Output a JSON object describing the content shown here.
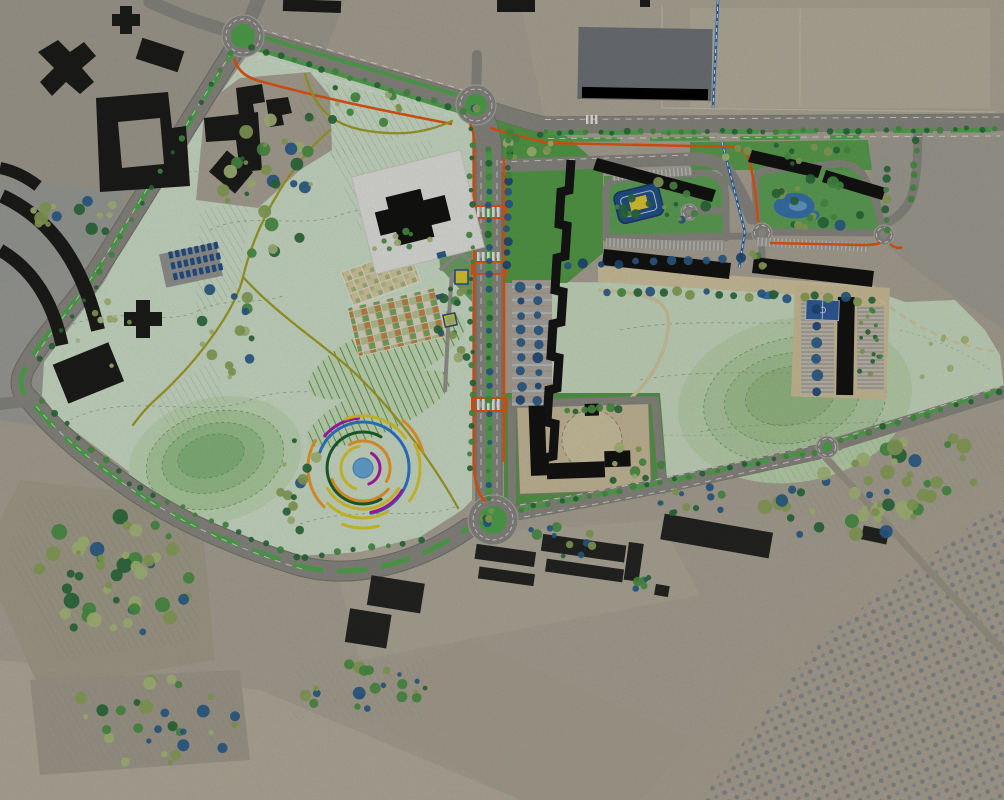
{
  "map": {
    "kind": "landscape-masterplan-over-aerial-photo",
    "canvas": {
      "width": 1004,
      "height": 800
    },
    "palette": {
      "aerial_base": "#b2ab9c",
      "aerial_cool": "#a3a49c",
      "park_mint": "#d5e7d1",
      "meadow_mint": "#cfe3c8",
      "lawn_green": "#58a24c",
      "median_green": "#55ad52",
      "route_orange": "#ee5a14",
      "canal_blue": "#2e6cb0",
      "road_gray": "#908e86",
      "building_black": "#1c1c1b",
      "white_parcel": "#ebebe8",
      "pond_blue": "#3b77b5",
      "court_blue": "#31609f",
      "pavilion_yellow": "#e7cf36",
      "garden_tan": "#d2c49c",
      "garden_orange": "#c98b4f",
      "garden_green": "#7fae62"
    },
    "features": [
      {
        "id": "central-park",
        "name": "Central park with land-art circle feature"
      },
      {
        "id": "main-boulevard",
        "name": "North-south boulevard with planted median"
      },
      {
        "id": "cycle-route",
        "name": "Orange cycle route"
      },
      {
        "id": "canal",
        "name": "Blue water channel"
      },
      {
        "id": "community-gardens",
        "name": "Community garden allotment grids"
      },
      {
        "id": "terraced-fields",
        "name": "Terraced planting stripes"
      },
      {
        "id": "residential-cluster-east",
        "name": "New residential courtyard blocks"
      },
      {
        "id": "school-campus",
        "name": "School campus with circular yard"
      },
      {
        "id": "sports-court",
        "name": "Sports court"
      },
      {
        "id": "playground",
        "name": "Courtyard playground"
      },
      {
        "id": "pond",
        "name": "Courtyard pond"
      },
      {
        "id": "orchard-fields",
        "name": "Orchard rows in south-east fields"
      },
      {
        "id": "existing-city",
        "name": "Existing city blocks on aerial photo"
      },
      {
        "id": "roundabouts",
        "name": "Roundabout junctions"
      }
    ],
    "land_art": {
      "center": {
        "x": 363,
        "y": 468,
        "radius": 10,
        "color": "#6aaede"
      },
      "arc_width": 3,
      "arcs": [
        {
          "r": 17,
          "a0": -70,
          "a1": 60,
          "color": "#b31bb3"
        },
        {
          "r": 22,
          "a0": 100,
          "a1": 250,
          "color": "#e3cf2e"
        },
        {
          "r": 27,
          "a0": -30,
          "a1": 120,
          "color": "#f5a12c"
        },
        {
          "r": 33,
          "a0": 200,
          "a1": 320,
          "color": "#f5a12c"
        },
        {
          "r": 36,
          "a0": 60,
          "a1": 300,
          "color": "#1e642e"
        },
        {
          "r": 41,
          "a0": 210,
          "a1": 330,
          "color": "#e3cf2e"
        },
        {
          "r": 46,
          "a0": -80,
          "a1": 160,
          "color": "#2e7ed2"
        },
        {
          "r": 45,
          "a0": 280,
          "a1": 330,
          "color": "#b31bb3"
        },
        {
          "r": 50,
          "a0": 95,
          "a1": 140,
          "color": "#b31bb3"
        },
        {
          "r": 50,
          "a0": 225,
          "a1": 300,
          "color": "#e3cf2e"
        },
        {
          "r": 52,
          "a0": 35,
          "a1": 110,
          "color": "#e3cf2e"
        },
        {
          "r": 55,
          "a0": 150,
          "a1": 225,
          "color": "#f5a12c"
        },
        {
          "r": 57,
          "a0": -35,
          "a1": 25,
          "color": "#e3cf2e"
        },
        {
          "r": 60,
          "a0": 250,
          "a1": 285,
          "color": "#e3cf2e"
        },
        {
          "r": 62,
          "a0": 15,
          "a1": 50,
          "color": "#f5a12c"
        }
      ]
    },
    "vegetation": {
      "palette": {
        "blue": "#2d618f",
        "navy": "#1f4e7c",
        "olive": "#8fa85c",
        "sage": "#aec17f",
        "dark": "#2e6f3e",
        "green": "#4c9648",
        "pale": "#b9c98f"
      },
      "clusters": [
        {
          "cx": 268,
          "cy": 190,
          "rx": 45,
          "ry": 85,
          "n": 30,
          "rmin": 2,
          "rmax": 7,
          "pal": [
            "blue",
            "olive",
            "sage",
            "dark",
            "green"
          ],
          "seed": 1
        },
        {
          "cx": 350,
          "cy": 105,
          "rx": 55,
          "ry": 22,
          "n": 12,
          "rmin": 2,
          "rmax": 5,
          "pal": [
            "olive",
            "sage",
            "dark",
            "green"
          ],
          "seed": 2
        },
        {
          "cx": 80,
          "cy": 215,
          "rx": 55,
          "ry": 22,
          "n": 14,
          "rmin": 2.5,
          "rmax": 7,
          "pal": [
            "blue",
            "olive",
            "sage",
            "dark"
          ],
          "seed": 3
        },
        {
          "cx": 228,
          "cy": 330,
          "rx": 28,
          "ry": 55,
          "n": 16,
          "rmin": 2,
          "rmax": 6,
          "pal": [
            "blue",
            "olive",
            "sage",
            "dark",
            "green"
          ],
          "seed": 4
        },
        {
          "cx": 298,
          "cy": 485,
          "rx": 25,
          "ry": 48,
          "n": 13,
          "rmin": 2,
          "rmax": 6,
          "pal": [
            "blue",
            "olive",
            "sage",
            "dark"
          ],
          "seed": 5
        },
        {
          "cx": 115,
          "cy": 575,
          "rx": 80,
          "ry": 62,
          "n": 48,
          "rmin": 2.5,
          "rmax": 8,
          "pal": [
            "blue",
            "olive",
            "sage",
            "dark",
            "green",
            "olive"
          ],
          "seed": 7
        },
        {
          "cx": 150,
          "cy": 722,
          "rx": 92,
          "ry": 44,
          "n": 30,
          "rmin": 2.5,
          "rmax": 7,
          "pal": [
            "blue",
            "olive",
            "sage",
            "dark",
            "green"
          ],
          "seed": 8
        },
        {
          "cx": 360,
          "cy": 688,
          "rx": 68,
          "ry": 26,
          "n": 22,
          "rmin": 2,
          "rmax": 6.5,
          "pal": [
            "blue",
            "olive",
            "dark",
            "green"
          ],
          "seed": 9
        },
        {
          "cx": 872,
          "cy": 488,
          "rx": 112,
          "ry": 46,
          "n": 55,
          "rmin": 2.5,
          "rmax": 8,
          "pal": [
            "blue",
            "olive",
            "sage",
            "dark",
            "green",
            "olive"
          ],
          "seed": 10,
          "rot": -15
        },
        {
          "cx": 560,
          "cy": 542,
          "rx": 40,
          "ry": 18,
          "n": 11,
          "rmin": 2,
          "rmax": 5.5,
          "pal": [
            "blue",
            "olive",
            "dark",
            "green"
          ],
          "seed": 11
        },
        {
          "cx": 695,
          "cy": 505,
          "rx": 42,
          "ry": 20,
          "n": 12,
          "rmin": 2,
          "rmax": 5.5,
          "pal": [
            "blue",
            "olive",
            "dark",
            "green"
          ],
          "seed": 12
        },
        {
          "cx": 662,
          "cy": 205,
          "rx": 48,
          "ry": 23,
          "n": 17,
          "rmin": 2,
          "rmax": 5.5,
          "pal": [
            "olive",
            "dark",
            "green",
            "blue",
            "dark",
            "green"
          ],
          "seed": 13
        },
        {
          "cx": 818,
          "cy": 202,
          "rx": 52,
          "ry": 26,
          "n": 18,
          "rmin": 2,
          "rmax": 6,
          "pal": [
            "olive",
            "dark",
            "green",
            "blue",
            "dark",
            "green"
          ],
          "seed": 14
        },
        {
          "cx": 792,
          "cy": 155,
          "rx": 68,
          "ry": 11,
          "n": 13,
          "rmin": 2,
          "rmax": 4.5,
          "pal": [
            "olive",
            "sage",
            "dark",
            "green"
          ],
          "seed": 15
        },
        {
          "cx": 452,
          "cy": 330,
          "rx": 17,
          "ry": 62,
          "n": 15,
          "rmin": 2,
          "rmax": 5,
          "pal": [
            "blue",
            "olive",
            "sage",
            "dark",
            "green"
          ],
          "seed": 16
        },
        {
          "cx": 398,
          "cy": 242,
          "rx": 42,
          "ry": 16,
          "n": 9,
          "rmin": 2,
          "rmax": 4.5,
          "pal": [
            "olive",
            "sage",
            "dark",
            "green"
          ],
          "seed": 17
        },
        {
          "cx": 622,
          "cy": 468,
          "rx": 40,
          "ry": 25,
          "n": 9,
          "rmin": 2.5,
          "rmax": 5.5,
          "pal": [
            "olive",
            "sage",
            "dark",
            "green"
          ],
          "seed": 18
        },
        {
          "cx": 532,
          "cy": 148,
          "rx": 28,
          "ry": 14,
          "n": 9,
          "rmin": 2.5,
          "rmax": 5.5,
          "pal": [
            "olive",
            "sage",
            "dark",
            "green"
          ],
          "seed": 23
        },
        {
          "cx": 938,
          "cy": 352,
          "rx": 38,
          "ry": 28,
          "n": 6,
          "rmin": 2,
          "rmax": 4.5,
          "pal": [
            "sage",
            "pale"
          ],
          "seed": 27
        },
        {
          "cx": 95,
          "cy": 330,
          "rx": 40,
          "ry": 40,
          "n": 8,
          "rmin": 2,
          "rmax": 4,
          "pal": [
            "sage",
            "pale",
            "olive"
          ],
          "seed": 37
        },
        {
          "cx": 760,
          "cy": 258,
          "rx": 12,
          "ry": 8,
          "n": 5,
          "rmin": 2,
          "rmax": 4,
          "pal": [
            "olive",
            "dark",
            "green"
          ],
          "seed": 30
        },
        {
          "cx": 640,
          "cy": 585,
          "rx": 18,
          "ry": 10,
          "n": 6,
          "rmin": 2,
          "rmax": 5,
          "pal": [
            "blue",
            "dark",
            "green"
          ],
          "seed": 32
        },
        {
          "cx": 869,
          "cy": 348,
          "rx": 12,
          "ry": 40,
          "n": 16,
          "rmin": 1.8,
          "rmax": 2.8,
          "pal": [
            "green",
            "dark",
            "olive"
          ],
          "seed": 33
        }
      ],
      "rows": [
        {
          "a": [
            252,
            48
          ],
          "b": [
            462,
            110
          ],
          "n": 16,
          "r": 2.8,
          "pal": [
            "dark",
            "green"
          ],
          "j": 1.5,
          "seed": 41
        },
        {
          "a": [
            232,
            52
          ],
          "b": [
            100,
            272
          ],
          "n": 14,
          "r": 2.6,
          "pal": [
            "dark",
            "green"
          ],
          "j": 2,
          "seed": 42
        },
        {
          "a": [
            96,
            286
          ],
          "b": [
            40,
            360
          ],
          "n": 6,
          "r": 2.5,
          "pal": [
            "dark"
          ],
          "j": 1.5,
          "seed": 43
        },
        {
          "a": [
            40,
            402
          ],
          "b": [
            130,
            482
          ],
          "n": 8,
          "r": 2.8,
          "pal": [
            "dark",
            "green"
          ],
          "j": 2,
          "seed": 44
        },
        {
          "a": [
            140,
            488
          ],
          "b": [
            295,
            557
          ],
          "n": 12,
          "r": 2.8,
          "pal": [
            "dark",
            "green"
          ],
          "j": 2,
          "seed": 45
        },
        {
          "a": [
            305,
            558
          ],
          "b": [
            420,
            540
          ],
          "n": 8,
          "r": 2.8,
          "pal": [
            "dark",
            "green"
          ],
          "j": 2,
          "seed": 46
        },
        {
          "a": [
            545,
            133
          ],
          "b": [
            995,
            129
          ],
          "n": 34,
          "r": 2.7,
          "pal": [
            "dark",
            "green"
          ],
          "j": 1.5,
          "seed": 47
        },
        {
          "a": [
            489,
            150
          ],
          "b": [
            489,
            498
          ],
          "n": 26,
          "r": 3,
          "pal": [
            "green",
            "dark",
            "blue"
          ],
          "j": 1,
          "seed": 48
        },
        {
          "a": [
            471,
            130
          ],
          "b": [
            471,
            470
          ],
          "n": 24,
          "r": 2.6,
          "pal": [
            "green",
            "dark"
          ],
          "j": 2,
          "seed": 49
        },
        {
          "a": [
            508,
            180
          ],
          "b": [
            508,
            265
          ],
          "n": 8,
          "r": 4,
          "pal": [
            "blue",
            "navy"
          ],
          "j": 1.5,
          "seed": 50
        },
        {
          "a": [
            509,
            132
          ],
          "b": [
            509,
            175
          ],
          "n": 6,
          "r": 3,
          "pal": [
            "dark",
            "green"
          ],
          "j": 1.5,
          "seed": 51
        },
        {
          "a": [
            520,
            509
          ],
          "b": [
            815,
            452
          ],
          "n": 22,
          "r": 2.8,
          "pal": [
            "dark",
            "green"
          ],
          "j": 1.5,
          "seed": 52
        },
        {
          "a": [
            840,
            441
          ],
          "b": [
            1000,
            392
          ],
          "n": 12,
          "r": 2.8,
          "pal": [
            "dark",
            "green"
          ],
          "j": 1.5,
          "seed": 53
        },
        {
          "a": [
            608,
            290
          ],
          "b": [
            872,
            300
          ],
          "n": 20,
          "r": 4,
          "pal": [
            "blue",
            "olive",
            "dark",
            "green"
          ],
          "j": 2.5,
          "seed": 54
        },
        {
          "a": [
            888,
            168
          ],
          "b": [
            886,
            230
          ],
          "n": 7,
          "r": 3.5,
          "pal": [
            "olive",
            "dark",
            "green"
          ],
          "j": 1.5,
          "seed": 55
        },
        {
          "a": [
            917,
            140
          ],
          "b": [
            911,
            200
          ],
          "n": 6,
          "r": 3,
          "pal": [
            "dark",
            "green"
          ],
          "j": 1.5,
          "seed": 56
        },
        {
          "a": [
            566,
            412
          ],
          "b": [
            618,
            408
          ],
          "n": 7,
          "r": 3.5,
          "pal": [
            "dark",
            "green"
          ],
          "j": 1.5,
          "seed": 57
        },
        {
          "a": [
            567,
            265
          ],
          "b": [
            740,
            258
          ],
          "n": 11,
          "r": 4,
          "pal": [
            "blue",
            "navy"
          ],
          "j": 1.5,
          "seed": 58
        },
        {
          "a": [
            521,
            287
          ],
          "b": [
            521,
            400
          ],
          "n": 9,
          "r": 4.2,
          "pal": [
            "blue",
            "navy"
          ],
          "j": 1,
          "seed": 59
        },
        {
          "a": [
            538,
            287
          ],
          "b": [
            538,
            400
          ],
          "n": 9,
          "r": 4.2,
          "pal": [
            "blue",
            "navy"
          ],
          "j": 1,
          "seed": 60
        },
        {
          "a": [
            817,
            310
          ],
          "b": [
            817,
            392
          ],
          "n": 6,
          "r": 4.5,
          "pal": [
            "blue",
            "navy"
          ],
          "j": 1,
          "seed": 61
        }
      ]
    },
    "roundabouts": [
      {
        "x": 243,
        "y": 36,
        "ro": 21,
        "ri": 12,
        "green": true,
        "trees": 0
      },
      {
        "x": 476,
        "y": 105,
        "ro": 20,
        "ri": 11,
        "green": true,
        "trees": 2
      },
      {
        "x": 493,
        "y": 520,
        "ro": 25,
        "ri": 14,
        "green": true,
        "trees": 7
      },
      {
        "x": 762,
        "y": 233,
        "ro": 10,
        "ri": 4,
        "green": false,
        "trees": 0
      },
      {
        "x": 884,
        "y": 235,
        "ro": 10,
        "ri": 4,
        "green": false,
        "trees": 0
      },
      {
        "x": 827,
        "y": 447,
        "ro": 11,
        "ri": 5,
        "green": true,
        "trees": 0
      },
      {
        "x": 689,
        "y": 212,
        "ro": 8,
        "ri": 3,
        "green": false,
        "trees": 0
      }
    ],
    "carparks": [
      {
        "x": 168,
        "y": 252,
        "rot": -12,
        "rows": 3,
        "cols": 8,
        "dx": 6.6,
        "dy": 11,
        "w": 4.2,
        "h": 7,
        "color": "#24538f"
      }
    ]
  }
}
